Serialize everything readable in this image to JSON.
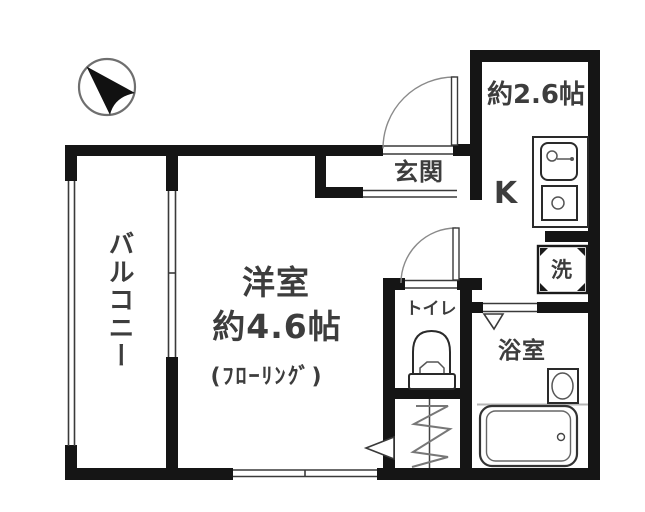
{
  "floorplan": {
    "rooms": {
      "balcony": {
        "label": "バルコニー"
      },
      "main_room": {
        "name": "洋室",
        "size": "約4.6帖",
        "floor_note": "(ﾌﾛｰﾘﾝｸﾞ)"
      },
      "entrance": {
        "label": "玄関"
      },
      "kitchen": {
        "label": "K",
        "size": "約2.6帖"
      },
      "laundry": {
        "label": "洗"
      },
      "toilet": {
        "label": "トイレ"
      },
      "bathroom": {
        "label": "浴室"
      }
    },
    "icons": {
      "compass": "north-arrow-icon",
      "kitchen_sink": "sink-icon",
      "stove": "stove-icon",
      "washer_pan": "washing-machine-icon",
      "toilet_bowl": "toilet-icon",
      "bathtub": "bathtub-icon",
      "wash_basin": "basin-icon",
      "ladder": "ladder-icon",
      "door_swing": "door-arc-icon"
    },
    "colors": {
      "wall": "#151515",
      "line": "#3a3a3a",
      "text": "#3d3d3d",
      "muted": "#8a8a8a",
      "background": "#ffffff"
    }
  }
}
